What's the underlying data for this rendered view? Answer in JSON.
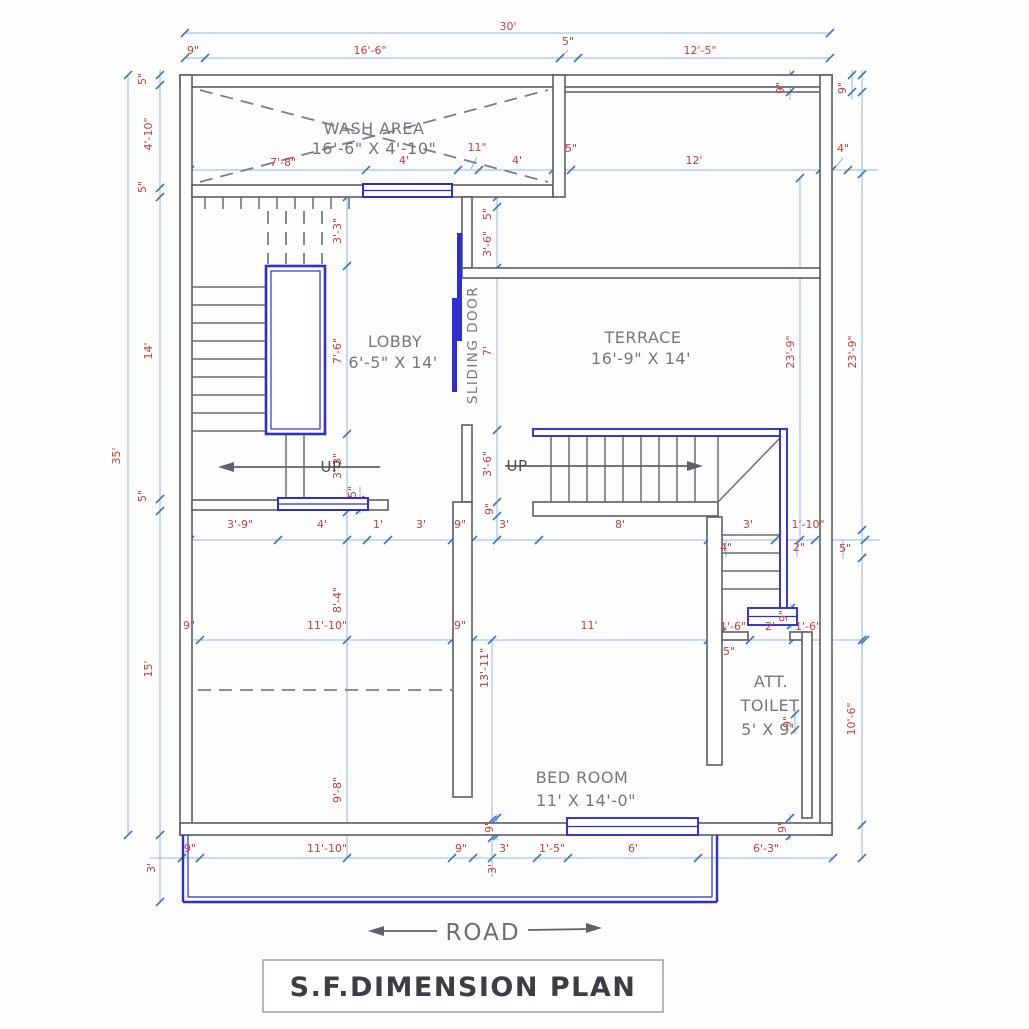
{
  "title": "S.F.DIMENSION PLAN",
  "road_label": "ROAD",
  "rooms": {
    "wash_area": {
      "name": "WASH AREA",
      "size": "16'-6\" X 4'-10\""
    },
    "lobby": {
      "name": "LOBBY",
      "size": "6'-5\" X 14'"
    },
    "terrace": {
      "name": "TERRACE",
      "size": "16'-9\" X 14'"
    },
    "bed_room": {
      "name": "BED ROOM",
      "size": "11' X 14'-0\""
    },
    "att_toilet": {
      "name_line1": "ATT.",
      "name_line2": "TOILET",
      "size": "5' X 9'"
    },
    "sliding_door": "SLIDING DOOR",
    "up_left": "UP",
    "up_right": "UP"
  },
  "colors": {
    "wall": "#5b5e63",
    "blue_element": "#2b2fd4",
    "dim_line": "#8fb6e2",
    "dim_tick": "#3f74c2",
    "dim_text": "#cf3a3a",
    "room_text": "#74787d",
    "title_text": "#3a3f45"
  },
  "dim_labels": [
    {
      "t": "30'",
      "x": 508,
      "y": 30,
      "r": 0
    },
    {
      "t": "9\"",
      "x": 193,
      "y": 54,
      "r": 0
    },
    {
      "t": "16'-6\"",
      "x": 370,
      "y": 54,
      "r": 0
    },
    {
      "t": "5\"",
      "x": 568,
      "y": 45,
      "r": 0
    },
    {
      "t": "12'-5\"",
      "x": 700,
      "y": 54,
      "r": 0
    },
    {
      "t": "9\"",
      "x": 784,
      "y": 88,
      "r": 1
    },
    {
      "t": "9\"",
      "x": 846,
      "y": 88,
      "r": 1
    },
    {
      "t": "4\"",
      "x": 843,
      "y": 152,
      "r": 0
    },
    {
      "t": "7'-8\"",
      "x": 283,
      "y": 166,
      "r": 0
    },
    {
      "t": "4'",
      "x": 404,
      "y": 164,
      "r": 0
    },
    {
      "t": "11\"",
      "x": 477,
      "y": 151,
      "r": 0
    },
    {
      "t": "4'",
      "x": 517,
      "y": 164,
      "r": 0
    },
    {
      "t": "5\"",
      "x": 571,
      "y": 152,
      "r": 0
    },
    {
      "t": "12'",
      "x": 694,
      "y": 164,
      "r": 0
    },
    {
      "t": "5\"",
      "x": 146,
      "y": 79,
      "r": 1
    },
    {
      "t": "4'-10\"",
      "x": 152,
      "y": 134,
      "r": 1
    },
    {
      "t": "5\"",
      "x": 146,
      "y": 187,
      "r": 1
    },
    {
      "t": "14'",
      "x": 152,
      "y": 351,
      "r": 1
    },
    {
      "t": "35'",
      "x": 120,
      "y": 456,
      "r": 1
    },
    {
      "t": "5\"",
      "x": 146,
      "y": 496,
      "r": 1
    },
    {
      "t": "15'",
      "x": 152,
      "y": 669,
      "r": 1
    },
    {
      "t": "3'",
      "x": 155,
      "y": 868,
      "r": 1
    },
    {
      "t": "3'-3\"",
      "x": 341,
      "y": 231,
      "r": 1
    },
    {
      "t": "7'-6\"",
      "x": 341,
      "y": 351,
      "r": 1
    },
    {
      "t": "3'-3\"",
      "x": 341,
      "y": 466,
      "r": 1
    },
    {
      "t": "5\"",
      "x": 356,
      "y": 492,
      "r": 1
    },
    {
      "t": "5\"",
      "x": 491,
      "y": 214,
      "r": 1
    },
    {
      "t": "3'-6\"",
      "x": 491,
      "y": 244,
      "r": 1
    },
    {
      "t": "7'",
      "x": 491,
      "y": 351,
      "r": 1
    },
    {
      "t": "3'-6\"",
      "x": 491,
      "y": 464,
      "r": 1
    },
    {
      "t": "9\"",
      "x": 493,
      "y": 509,
      "r": 1
    },
    {
      "t": "23'-9\"",
      "x": 794,
      "y": 352,
      "r": 1
    },
    {
      "t": "23'-9\"",
      "x": 856,
      "y": 352,
      "r": 1
    },
    {
      "t": "3'-9\"",
      "x": 240,
      "y": 528,
      "r": 0
    },
    {
      "t": "4'",
      "x": 322,
      "y": 528,
      "r": 0
    },
    {
      "t": "1'",
      "x": 378,
      "y": 528,
      "r": 0
    },
    {
      "t": "3'",
      "x": 421,
      "y": 528,
      "r": 0
    },
    {
      "t": "9\"",
      "x": 460,
      "y": 528,
      "r": 0
    },
    {
      "t": "3'",
      "x": 504,
      "y": 528,
      "r": 0
    },
    {
      "t": "8'",
      "x": 620,
      "y": 528,
      "r": 0
    },
    {
      "t": "3'",
      "x": 748,
      "y": 528,
      "r": 0
    },
    {
      "t": "1'-10\"",
      "x": 808,
      "y": 528,
      "r": 0
    },
    {
      "t": "4\"",
      "x": 726,
      "y": 551,
      "r": 0
    },
    {
      "t": "2\"",
      "x": 799,
      "y": 551,
      "r": 0
    },
    {
      "t": "5\"",
      "x": 845,
      "y": 552,
      "r": 0
    },
    {
      "t": "9\"",
      "x": 787,
      "y": 616,
      "r": 1
    },
    {
      "t": "9\"",
      "x": 189,
      "y": 629,
      "r": 0
    },
    {
      "t": "11'-10\"",
      "x": 327,
      "y": 629,
      "r": 0
    },
    {
      "t": "9\"",
      "x": 460,
      "y": 629,
      "r": 0
    },
    {
      "t": "11'",
      "x": 589,
      "y": 629,
      "r": 0
    },
    {
      "t": "1'-6\"",
      "x": 733,
      "y": 630,
      "r": 0
    },
    {
      "t": "2'",
      "x": 770,
      "y": 630,
      "r": 0
    },
    {
      "t": "1'-6\"",
      "x": 808,
      "y": 630,
      "r": 0
    },
    {
      "t": "5\"",
      "x": 729,
      "y": 655,
      "r": 0
    },
    {
      "t": "8'-4\"",
      "x": 341,
      "y": 600,
      "r": 1
    },
    {
      "t": "13'-11\"",
      "x": 488,
      "y": 668,
      "r": 1
    },
    {
      "t": "10'-6\"",
      "x": 855,
      "y": 719,
      "r": 1
    },
    {
      "t": "9\"",
      "x": 791,
      "y": 722,
      "r": 1
    },
    {
      "t": "9'-8\"",
      "x": 341,
      "y": 790,
      "r": 1
    },
    {
      "t": "9\"",
      "x": 493,
      "y": 827,
      "r": 1
    },
    {
      "t": "9\"",
      "x": 786,
      "y": 827,
      "r": 1
    },
    {
      "t": "9\"",
      "x": 190,
      "y": 852,
      "r": 0
    },
    {
      "t": "11'-10\"",
      "x": 327,
      "y": 852,
      "r": 0
    },
    {
      "t": "9\"",
      "x": 461,
      "y": 852,
      "r": 0
    },
    {
      "t": "3'",
      "x": 504,
      "y": 852,
      "r": 0
    },
    {
      "t": "1'-5\"",
      "x": 552,
      "y": 852,
      "r": 0
    },
    {
      "t": "6'",
      "x": 633,
      "y": 852,
      "r": 0
    },
    {
      "t": "6'-3\"",
      "x": 766,
      "y": 852,
      "r": 0
    },
    {
      "t": "3'",
      "x": 496,
      "y": 869,
      "r": 1
    }
  ]
}
